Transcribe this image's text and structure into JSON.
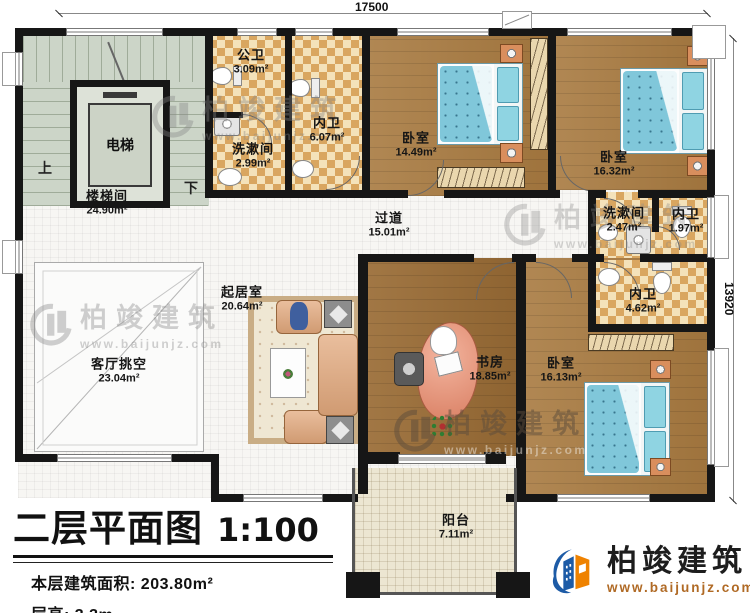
{
  "plan": {
    "title": "二层平面图",
    "scale": "1:100",
    "stats": [
      {
        "label": "本层建筑面积:",
        "value": "203.80m²"
      },
      {
        "label": "层高:",
        "value": "3.3m"
      }
    ]
  },
  "dimensions": {
    "top": "17500",
    "right": "13920"
  },
  "stairs": {
    "up_label": "上",
    "down_label": "下",
    "elevator_label": "电梯"
  },
  "rooms": [
    {
      "name": "楼梯间",
      "area": "24.90m²"
    },
    {
      "name": "电梯",
      "area": ""
    },
    {
      "name": "公卫",
      "area": "3.09m²"
    },
    {
      "name": "洗漱间",
      "area": "2.99m²"
    },
    {
      "name": "内卫",
      "area": "6.07m²"
    },
    {
      "name": "卧室",
      "area": "14.49m²"
    },
    {
      "name": "卧室",
      "area": "16.32m²"
    },
    {
      "name": "过道",
      "area": "15.01m²"
    },
    {
      "name": "洗漱间",
      "area": "2.47m²"
    },
    {
      "name": "内卫",
      "area": "1.97m²"
    },
    {
      "name": "内卫",
      "area": "4.62m²"
    },
    {
      "name": "起居室",
      "area": "20.64m²"
    },
    {
      "name": "客厅挑空",
      "area": "23.04m²"
    },
    {
      "name": "书房",
      "area": "18.85m²"
    },
    {
      "name": "卧室",
      "area": "16.13m²"
    },
    {
      "name": "阳台",
      "area": "7.11m²"
    }
  ],
  "brand": {
    "name": "柏竣建筑",
    "url": "www.baijunjz.com"
  },
  "watermark": {
    "name": "柏竣建筑",
    "url": "www.baijunjz.com"
  },
  "colors": {
    "wall": "#161616",
    "wood": "#a87a40",
    "tile": "#d9a660",
    "stair": "#ccd5c8",
    "balcony": "#ece6d2",
    "bed": "#80c7da",
    "logo_blue": "#1d5ba6",
    "logo_orange": "#ef8200",
    "url_orange": "#b06a25"
  }
}
